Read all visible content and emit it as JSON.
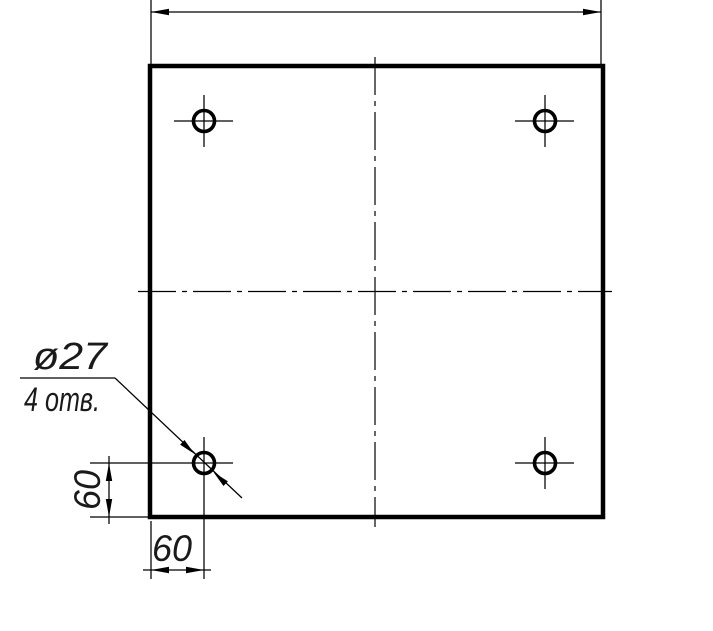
{
  "drawing": {
    "type": "technical-drawing",
    "description": "Square plate with four drilled holes, one in each corner region",
    "background_color": "#ffffff",
    "line_color": "#000000",
    "text_color": "#1a1a1a",
    "callout": {
      "diameter_label": "ø27",
      "holes_label": "4 отв."
    },
    "dimensions": {
      "dim_bottom_label": "60",
      "dim_left_label": "60"
    },
    "values": {
      "hole_diameter": 27,
      "hole_count": 4,
      "hole_offset_from_left_edge": 60,
      "hole_offset_from_bottom_edge": 60
    }
  }
}
